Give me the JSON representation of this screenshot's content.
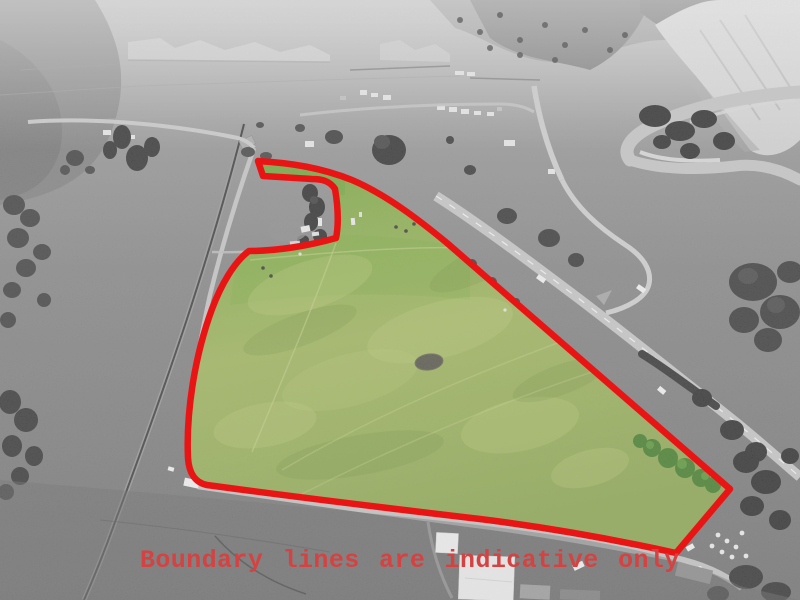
{
  "annotation": {
    "text": "Boundary lines are indicative only"
  },
  "colors": {
    "boundary-red": "#e91515",
    "annotation-red": "#d54242",
    "field-green-top": "#7cab43",
    "field-green-mid": "#a3b961",
    "field-green-bottom": "#90aa55",
    "tree-green": "#47802e",
    "tree-green-light": "#5d9a3c",
    "pond-gray": "#5a584b"
  },
  "boundary": {
    "path": "M258,161 C292,163 322,168 352,180 C385,194 418,219 447,243 L730,489 L676,553 C608,538 545,527 480,519 C395,509 295,497 207,485 C196,483 189,474 188,458 C186,414 194,358 212,309 C221,285 234,262 249,251 C276,251 308,246 336,238 C338,229 339,212 335,189 C330,181 322,179 312,179 L263,176 Z",
    "stroke_width": 6.5
  }
}
